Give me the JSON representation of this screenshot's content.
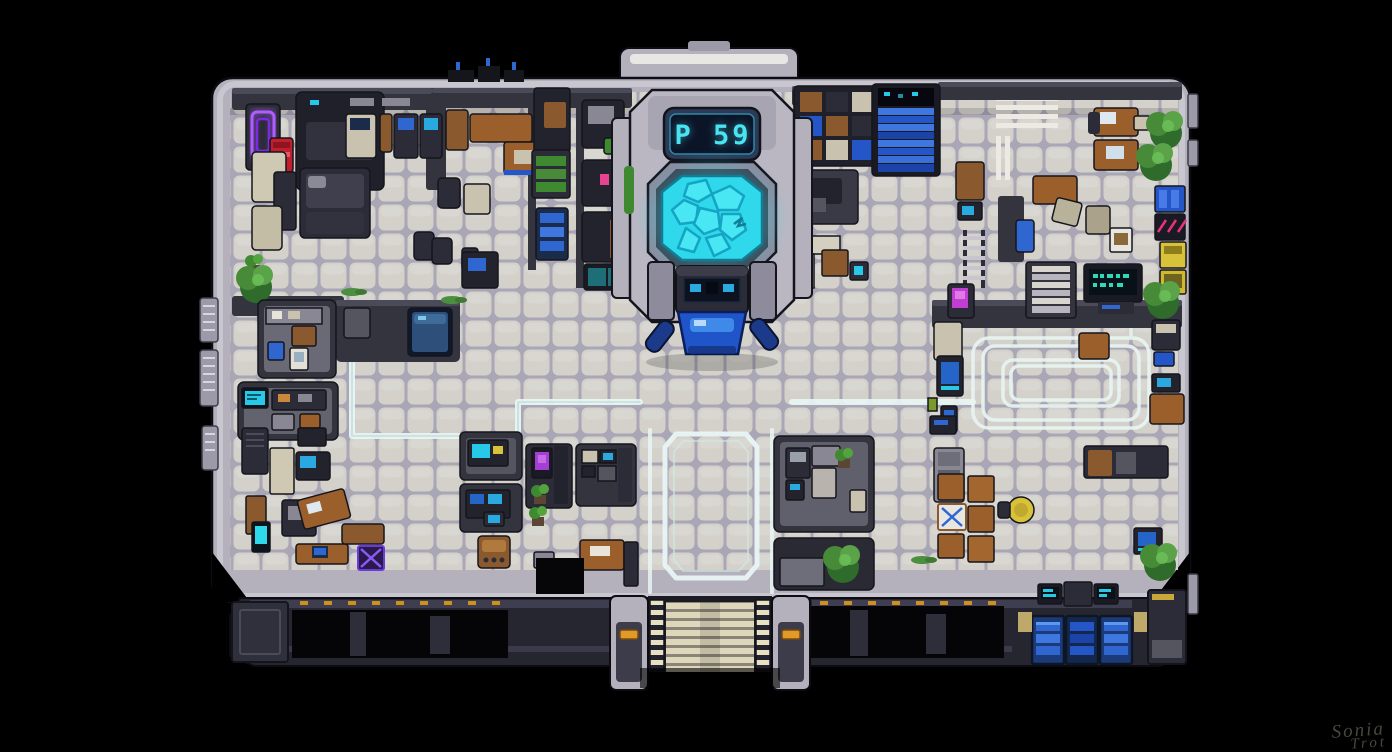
{
  "scene": {
    "description": "Top-down pixel-art sci-fi station floor map on a black background",
    "background_color": "#000000"
  },
  "reactor": {
    "display_text": "P 59",
    "screen_color": "#49e4f2",
    "pool_color": "#2fd8ea",
    "hologram_color": "#1f55c8"
  },
  "signature": {
    "line1": "Sonia",
    "line2": "Trot",
    "color": "#4d4c42"
  },
  "palette": {
    "floor_tile": "#d4d1cb",
    "tile_grout": "#a9a6b6",
    "hull_light": "#b6b3bf",
    "hull_highlight": "#e9e7e4",
    "wall_dark": "#34343f",
    "machine_dark": "#23232e",
    "accent_cyan": "#2fd8ea",
    "accent_blue": "#2f66d0",
    "neon_purple": "#b05cff",
    "neon_pink": "#e8327c",
    "wood_brown": "#9a5f2b",
    "crate_beige": "#c9c2ae",
    "plant_green": "#4c8f3f",
    "hazard_cream": "#e8e0c2",
    "vending_red": "#c21f2e",
    "vending_yellow": "#d8c23a",
    "hazard_orange": "#e09a28",
    "path_marking": "#e9f6f4"
  },
  "regions": {
    "northwest": [
      "lounge with purple neon wall sign",
      "red vending machine",
      "medical scanner pod with bed",
      "desk row with monitors",
      "office chairs",
      "potted plants"
    ],
    "north_center": [
      "wooden work desks",
      "hydroponic planters",
      "blue supply shelves",
      "teal double door",
      "wall alcove machines"
    ],
    "northeast": [
      "storage shelving with crates",
      "blue-lit staircase",
      "wall ladder",
      "zebra floor stripes",
      "wooden cabinet"
    ],
    "east_plaza": [
      "wooden desks with monitors",
      "trees",
      "blue lockers with pink graffiti",
      "yellow vending machines",
      "beige crates",
      "poster sign"
    ],
    "east_hall": [
      "nested white floor track markings",
      "terminal with green digital text",
      "white staircase",
      "server cabinet",
      "planter tables",
      "magenta-screen machine"
    ],
    "west": [
      "kitchenette room",
      "cyan wall sign room",
      "blue holo table wall band"
    ],
    "southwest": [
      "office consoles with monitors",
      "tilted wooden desk",
      "cyan kiosk",
      "purple crate marked with X",
      "beige standing locker"
    ],
    "south_center": [
      "console rooms",
      "purple-screen arcade cabinet",
      "wooden jukebox",
      "desk with keyboard",
      "dark vault opening",
      "octagonal floor marking corridor"
    ],
    "south_east": [
      "kitchen appliances",
      "classroom desk rows",
      "white desk with blue X",
      "round yellow table",
      "trees",
      "glowing blue wall vents",
      "cyan status screens"
    ],
    "exterior": [
      "industrial pipework facade",
      "south entry staircase with striped rails",
      "orange hazard lights",
      "north entrance block",
      "side airlock modules"
    ]
  }
}
